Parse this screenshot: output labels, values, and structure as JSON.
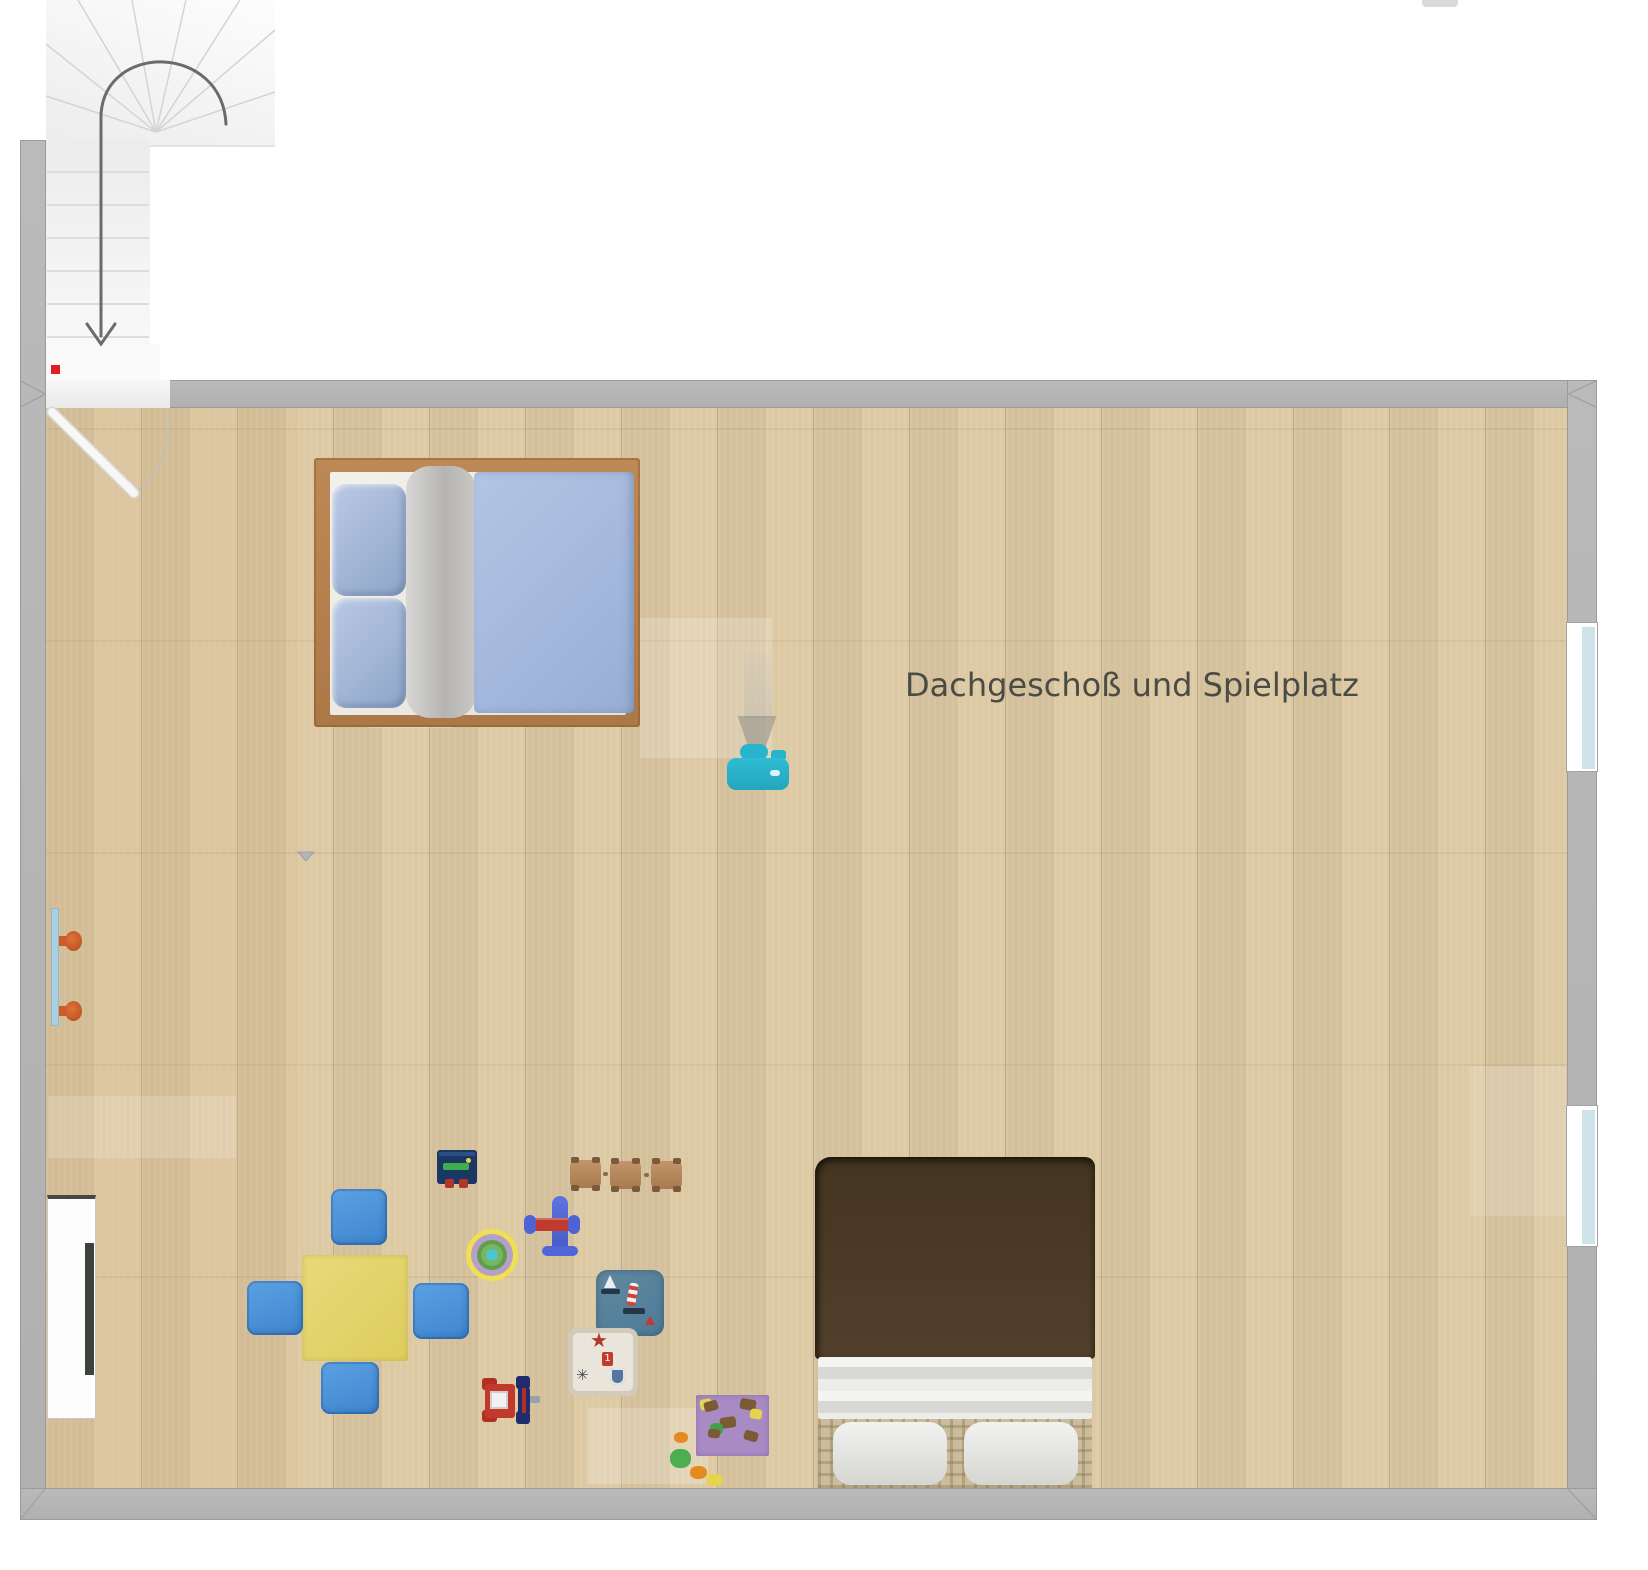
{
  "plan": {
    "title": "Dachgeschoß und Spielplatz"
  },
  "icons": {
    "star": "★",
    "snowflake": "✳",
    "digit_block": "1"
  },
  "palette": {
    "wall_gray": "#b5b5b5",
    "floor_wood": "#dcc8a2",
    "stair_white": "#f5f5f5",
    "marker_red": "#e01f1f",
    "arrow_gray": "#6b6b6b",
    "bed_frame_brown": "#b5814f",
    "bed_duvet_blue": "#a6bbde",
    "dark_bed_brown": "#4c3b28",
    "kids_table_yellow": "#e4d56d",
    "cushion_blue": "#4b94dc",
    "projector_teal": "#29b4cd",
    "hook_orange": "#cf5a26",
    "window_pane_blue": "#cfe3eb",
    "rug_purple": "#a98bc4",
    "rug_ocean_blue": "#57809f",
    "rug_star_cream": "#eae5db",
    "target_ring_yellow": "#efdf52",
    "toy_train_brown": "#b8885d",
    "toy_plane_blue": "#5166d6",
    "toy_plane_red": "#c13a30",
    "toy_car_red": "#b03026",
    "toy_car_navy": "#1f2d6e"
  },
  "objects": [
    {
      "id": "staircase",
      "label": "U-shaped staircase with down arrow"
    },
    {
      "id": "door",
      "label": "Hinged door, top-left corner"
    },
    {
      "id": "double-bed-blue",
      "label": "Double bed, blue duvet, two pillows"
    },
    {
      "id": "double-bed-brown",
      "label": "Double bed, dark brown duvet, two pillows"
    },
    {
      "id": "kids-table",
      "label": "Yellow kids play table"
    },
    {
      "id": "floor-cushions",
      "label": "Blue floor cushions",
      "count": 4
    },
    {
      "id": "projector",
      "label": "Teal projector with light beam"
    },
    {
      "id": "coat-rack",
      "label": "Wall rail with two orange hooks"
    },
    {
      "id": "sideboard",
      "label": "White sideboard with dark front"
    },
    {
      "id": "windows-right",
      "label": "Windows on right wall",
      "count": 2
    },
    {
      "id": "toy-register",
      "label": "Navy toy play board"
    },
    {
      "id": "toy-train",
      "label": "Wooden toy train, three cars"
    },
    {
      "id": "toy-plane",
      "label": "Blue and red toy biplane"
    },
    {
      "id": "target-mat",
      "label": "Round target play mat"
    },
    {
      "id": "rug-ocean",
      "label": "Blue ocean motif play rug"
    },
    {
      "id": "rug-star",
      "label": "Cream star motif play rug"
    },
    {
      "id": "toy-car",
      "label": "Red/white/navy toy car"
    },
    {
      "id": "rug-purple",
      "label": "Purple play rug with patches"
    },
    {
      "id": "scattered-toys",
      "label": "Small scattered toy pieces",
      "count": 4
    }
  ]
}
